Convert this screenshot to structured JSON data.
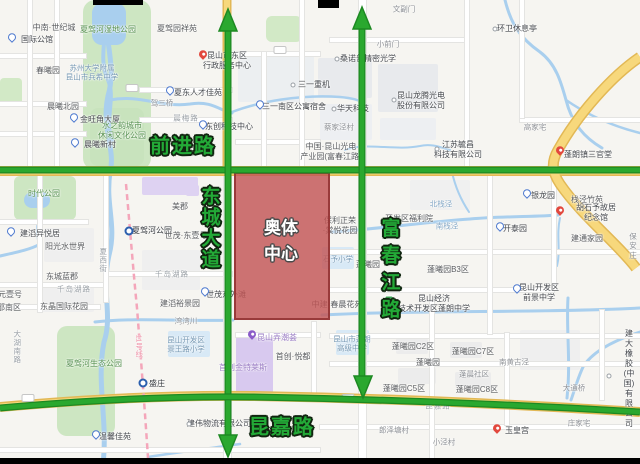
{
  "annotations": {
    "qianjin_road": "前进路",
    "dongcheng_avenue": "东城大道",
    "fuchunjiang_road": "富春江路",
    "kunjia_road": "昆嘉路",
    "olympic_center": "奥体\n中心",
    "metro_line_label": "11号线"
  },
  "colors": {
    "annotation_green": "#23aa37",
    "annotation_outline": "#10240f",
    "highlight_fill": "#c25656",
    "highlight_border": "#943434",
    "road_yellow": "#f7d87c",
    "water_blue": "#a9cfee",
    "park_green": "#cde6c2",
    "metro_line_pink": "#f4a6ba"
  },
  "map_labels": [
    {
      "t": "中南·世纪城",
      "x": 54,
      "y": 28,
      "c": "pl"
    },
    {
      "t": "国际公馆",
      "x": 37,
      "y": 40,
      "c": "poi"
    },
    {
      "t": "夏驾河湿地公园",
      "x": 108,
      "y": 30,
      "c": "pk"
    },
    {
      "t": "夏驾园祥苑",
      "x": 177,
      "y": 29,
      "c": "pl"
    },
    {
      "t": "春曦园",
      "x": 48,
      "y": 71,
      "c": "pl"
    },
    {
      "t": "苏州大学附属\n昆山市兵希中学",
      "x": 92,
      "y": 73,
      "c": "sc"
    },
    {
      "t": "晨曦北园",
      "x": 63,
      "y": 107,
      "c": "pl"
    },
    {
      "t": "金旺角大厦",
      "x": 100,
      "y": 120,
      "c": "poi"
    },
    {
      "t": "水之韵城市\n休闲文化公园",
      "x": 122,
      "y": 131,
      "c": "pk"
    },
    {
      "t": "晨曦新村",
      "x": 100,
      "y": 145,
      "c": "poi"
    },
    {
      "t": "晨梅路",
      "x": 186,
      "y": 118,
      "c": "rd"
    },
    {
      "t": "驾三桥",
      "x": 162,
      "y": 103,
      "c": "sm"
    },
    {
      "t": "夏东人才佳苑",
      "x": 198,
      "y": 93,
      "c": "poi"
    },
    {
      "t": "昆山市东区\n行政服务中心",
      "x": 227,
      "y": 61,
      "c": "poi"
    },
    {
      "t": "三一重机",
      "x": 314,
      "y": 85,
      "c": "poi"
    },
    {
      "t": "三一南区公寓宿舍",
      "x": 294,
      "y": 107,
      "c": "poi"
    },
    {
      "t": "东创科技中心",
      "x": 229,
      "y": 127,
      "c": "poi"
    },
    {
      "t": "文副门",
      "x": 404,
      "y": 9,
      "c": "sm"
    },
    {
      "t": "小前门",
      "x": 388,
      "y": 44,
      "c": "sm"
    },
    {
      "t": "桑诺普精密光学",
      "x": 368,
      "y": 59,
      "c": "poi"
    },
    {
      "t": "华天科技",
      "x": 353,
      "y": 109,
      "c": "poi"
    },
    {
      "t": "昆山龙腾光电\n股份有限公司",
      "x": 421,
      "y": 101,
      "c": "poi"
    },
    {
      "t": "环卫休息亭",
      "x": 517,
      "y": 29,
      "c": "poi"
    },
    {
      "t": "蔡家泾村",
      "x": 339,
      "y": 127,
      "c": "sm"
    },
    {
      "t": "中国·昆山光电\n产业园(富春江路)",
      "x": 331,
      "y": 152,
      "c": "pl"
    },
    {
      "t": "江苏毓昌\n科技有限公司",
      "x": 458,
      "y": 150,
      "c": "poi"
    },
    {
      "t": "蓬朗镇三官堂",
      "x": 588,
      "y": 155,
      "c": "poi"
    },
    {
      "t": "高家宅",
      "x": 535,
      "y": 127,
      "c": "sm"
    },
    {
      "t": "银龙园",
      "x": 543,
      "y": 196,
      "c": "poi"
    },
    {
      "t": "栈泾竹苑",
      "x": 587,
      "y": 200,
      "c": "pl"
    },
    {
      "t": "胡石予故居纪念馆",
      "x": 596,
      "y": 213,
      "c": "poi"
    },
    {
      "t": "开泰园",
      "x": 515,
      "y": 229,
      "c": "poi"
    },
    {
      "t": "建通家园",
      "x": 587,
      "y": 239,
      "c": "pl"
    },
    {
      "t": "保安庄",
      "x": 633,
      "y": 246,
      "c": "sm"
    },
    {
      "t": "北栈泾",
      "x": 441,
      "y": 204,
      "c": "wt"
    },
    {
      "t": "南栈泾",
      "x": 447,
      "y": 226,
      "c": "wt"
    },
    {
      "t": "保利正荣\n·棠悦花园",
      "x": 340,
      "y": 226,
      "c": "pl"
    },
    {
      "t": "石予小学",
      "x": 338,
      "y": 259,
      "c": "sc"
    },
    {
      "t": "开发区福利院",
      "x": 409,
      "y": 219,
      "c": "pl"
    },
    {
      "t": "蓬曦园",
      "x": 368,
      "y": 265,
      "c": "pl"
    },
    {
      "t": "蓬曦园B3区",
      "x": 448,
      "y": 270,
      "c": "pl"
    },
    {
      "t": "昆山经济\n技术开发区蓬朗中学",
      "x": 434,
      "y": 304,
      "c": "poi"
    },
    {
      "t": "昆山开发区\n前景中学",
      "x": 539,
      "y": 293,
      "c": "poi"
    },
    {
      "t": "蓬曦园C2区",
      "x": 413,
      "y": 347,
      "c": "pl"
    },
    {
      "t": "蓬曦园C7区",
      "x": 473,
      "y": 352,
      "c": "pl"
    },
    {
      "t": "蓬曦园",
      "x": 428,
      "y": 363,
      "c": "pl"
    },
    {
      "t": "蓬晨社区",
      "x": 474,
      "y": 374,
      "c": "sm"
    },
    {
      "t": "蓬曦园C5区",
      "x": 404,
      "y": 389,
      "c": "pl"
    },
    {
      "t": "蓬曦园C8区",
      "x": 477,
      "y": 390,
      "c": "pl"
    },
    {
      "t": "南黄古泾",
      "x": 514,
      "y": 362,
      "c": "sm"
    },
    {
      "t": "建大橡胶\n(中国)有限公司",
      "x": 629,
      "y": 379,
      "c": "poi"
    },
    {
      "t": "大通桥",
      "x": 574,
      "y": 388,
      "c": "sm"
    },
    {
      "t": "庄家宅",
      "x": 579,
      "y": 423,
      "c": "sm"
    },
    {
      "t": "郎泽塘村",
      "x": 394,
      "y": 430,
      "c": "sm"
    },
    {
      "t": "小泾村",
      "x": 444,
      "y": 442,
      "c": "sm"
    },
    {
      "t": "玉皇宫",
      "x": 517,
      "y": 431,
      "c": "poi"
    },
    {
      "t": "昆山市蓬朗\n高级中学",
      "x": 352,
      "y": 344,
      "c": "sc"
    },
    {
      "t": "中建·春晨花苑",
      "x": 337,
      "y": 305,
      "c": "pl"
    },
    {
      "t": "昆嘉路",
      "x": 438,
      "y": 406,
      "c": "rd"
    },
    {
      "t": "时代公园",
      "x": 44,
      "y": 194,
      "c": "pk"
    },
    {
      "t": "建滔异悦居",
      "x": 40,
      "y": 234,
      "c": "poi"
    },
    {
      "t": "阳光水世界",
      "x": 65,
      "y": 247,
      "c": "pl"
    },
    {
      "t": "夏西街",
      "x": 103,
      "y": 260,
      "c": "rdv"
    },
    {
      "t": "东城蓝郡",
      "x": 62,
      "y": 277,
      "c": "pl"
    },
    {
      "t": "千岛湖路",
      "x": 74,
      "y": 289,
      "c": "rd"
    },
    {
      "t": "千岛湖路",
      "x": 172,
      "y": 274,
      "c": "rd"
    },
    {
      "t": "元壹号",
      "x": 10,
      "y": 295,
      "c": "pl"
    },
    {
      "t": "邵南区",
      "x": 9,
      "y": 308,
      "c": "pl"
    },
    {
      "t": "东晶国际花园",
      "x": 64,
      "y": 307,
      "c": "pl"
    },
    {
      "t": "大湖南路",
      "x": 17,
      "y": 347,
      "c": "rdv"
    },
    {
      "t": "夏驾河生态公园",
      "x": 94,
      "y": 364,
      "c": "pk"
    },
    {
      "t": "湾湾川",
      "x": 186,
      "y": 321,
      "c": "sm"
    },
    {
      "t": "昆山开发区\n景王路小学",
      "x": 186,
      "y": 345,
      "c": "sc"
    },
    {
      "t": "盛庄",
      "x": 157,
      "y": 384,
      "c": "mt"
    },
    {
      "t": "夏驾河公园",
      "x": 152,
      "y": 231,
      "c": "mt"
    },
    {
      "t": "首创金特莱斯",
      "x": 243,
      "y": 368,
      "c": "pu"
    },
    {
      "t": "首创·悦都",
      "x": 293,
      "y": 357,
      "c": "pl"
    },
    {
      "t": "昆山弄潮荟",
      "x": 277,
      "y": 338,
      "c": "pu"
    },
    {
      "t": "建伟物流有限公司",
      "x": 219,
      "y": 424,
      "c": "poi"
    },
    {
      "t": "温馨佳苑",
      "x": 115,
      "y": 437,
      "c": "poi"
    },
    {
      "t": "美郡",
      "x": 180,
      "y": 207,
      "c": "pl"
    },
    {
      "t": "世茂·东壹号",
      "x": 186,
      "y": 236,
      "c": "pl"
    },
    {
      "t": "建滔裕景园",
      "x": 180,
      "y": 304,
      "c": "pl"
    },
    {
      "t": "世茂东外滩",
      "x": 226,
      "y": 295,
      "c": "poi"
    },
    {
      "t": "11号线",
      "x": 139,
      "y": 346,
      "c": "ml"
    }
  ],
  "pins": [
    {
      "k": "blue",
      "x": 12,
      "y": 40
    },
    {
      "k": "blue",
      "x": 74,
      "y": 120
    },
    {
      "k": "blue",
      "x": 75,
      "y": 145
    },
    {
      "k": "blue",
      "x": 170,
      "y": 93
    },
    {
      "k": "blue",
      "x": 260,
      "y": 107
    },
    {
      "k": "blue",
      "x": 203,
      "y": 127
    },
    {
      "k": "blue",
      "x": 527,
      "y": 196
    },
    {
      "k": "blue",
      "x": 500,
      "y": 229
    },
    {
      "k": "blue",
      "x": 517,
      "y": 291
    },
    {
      "k": "blue",
      "x": 11,
      "y": 234
    },
    {
      "k": "blue",
      "x": 96,
      "y": 437
    },
    {
      "k": "blue",
      "x": 205,
      "y": 294
    },
    {
      "k": "red",
      "x": 203,
      "y": 57
    },
    {
      "k": "red",
      "x": 560,
      "y": 153
    },
    {
      "k": "red",
      "x": 560,
      "y": 213
    },
    {
      "k": "red",
      "x": 497,
      "y": 431
    },
    {
      "k": "purple",
      "x": 252,
      "y": 337
    },
    {
      "k": "dot",
      "x": 293,
      "y": 85
    },
    {
      "k": "dot",
      "x": 337,
      "y": 59
    },
    {
      "k": "dot",
      "x": 334,
      "y": 109
    },
    {
      "k": "dot",
      "x": 394,
      "y": 100
    },
    {
      "k": "dot",
      "x": 495,
      "y": 29
    },
    {
      "k": "dot",
      "x": 437,
      "y": 149
    },
    {
      "k": "dot",
      "x": 609,
      "y": 376
    },
    {
      "k": "dot",
      "x": 189,
      "y": 424
    },
    {
      "k": "metro",
      "x": 129,
      "y": 231
    },
    {
      "k": "metro",
      "x": 143,
      "y": 383
    },
    {
      "k": "school",
      "x": 389,
      "y": 300
    },
    {
      "k": "badge",
      "x": 132,
      "y": 88
    },
    {
      "k": "badge",
      "x": 280,
      "y": 50
    },
    {
      "k": "badge",
      "x": 28,
      "y": 398
    },
    {
      "k": "badge",
      "x": 348,
      "y": 398
    }
  ]
}
